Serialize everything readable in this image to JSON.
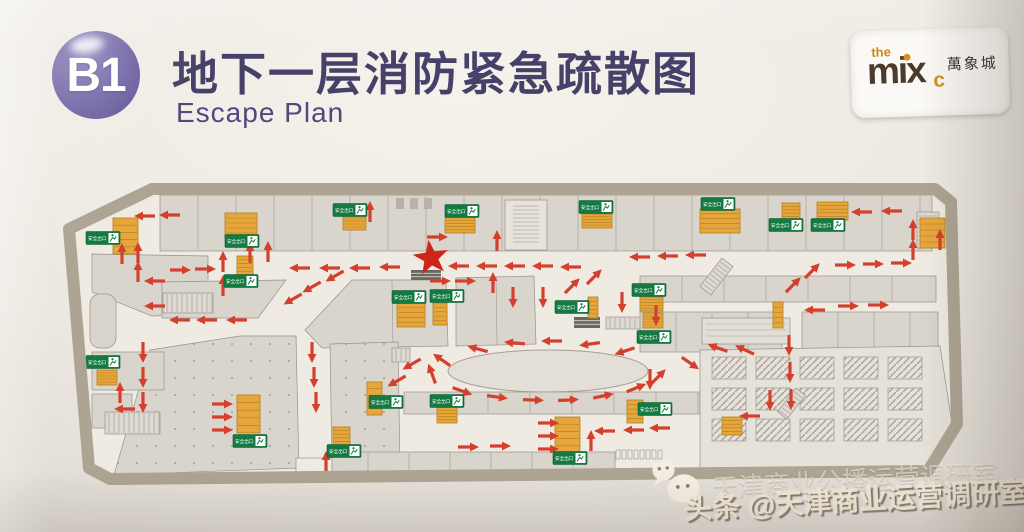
{
  "header": {
    "floor_badge": "B1",
    "title_zh": "地下一层消防紧急疏散图",
    "subtitle_en": "Escape Plan"
  },
  "logo": {
    "the": "the",
    "brand": "mix",
    "sub": "c",
    "cn": "萬象城"
  },
  "watermark": {
    "faint": "天津商业公播运营调研室",
    "main": "头条 @天津商业运营调研室",
    "icon": "wechat-icon"
  },
  "map": {
    "exit_label": "安全出口",
    "colors": {
      "arrow": "#d4402e",
      "exit_green": "#147a42",
      "exit_green_dark": "#0a5b31",
      "stair_orange": "#e7a63c",
      "stair_line": "#b07d1e",
      "star_red": "#cd2519",
      "floor": "#efebe3",
      "block": "#d9d5cc",
      "block_line": "#96918a",
      "border_band": "#aea494",
      "badge_purple": "#6c60a2",
      "title_ink": "#474169"
    },
    "star": {
      "x": 431,
      "y": 258
    },
    "exits": [
      [
        103,
        238
      ],
      [
        242,
        241
      ],
      [
        241,
        281
      ],
      [
        350,
        210
      ],
      [
        462,
        211
      ],
      [
        596,
        207
      ],
      [
        718,
        204
      ],
      [
        786,
        225
      ],
      [
        828,
        225
      ],
      [
        409,
        297
      ],
      [
        447,
        296
      ],
      [
        572,
        307
      ],
      [
        649,
        290
      ],
      [
        654,
        337
      ],
      [
        103,
        362
      ],
      [
        386,
        402
      ],
      [
        447,
        401
      ],
      [
        655,
        409
      ],
      [
        250,
        441
      ],
      [
        344,
        451
      ],
      [
        570,
        458
      ]
    ],
    "stairs": [
      [
        113,
        218,
        25,
        36
      ],
      [
        225,
        213,
        32,
        25
      ],
      [
        237,
        256,
        16,
        19
      ],
      [
        343,
        215,
        23,
        15
      ],
      [
        445,
        217,
        30,
        16
      ],
      [
        582,
        214,
        30,
        14
      ],
      [
        700,
        209,
        40,
        24
      ],
      [
        782,
        203,
        18,
        17
      ],
      [
        817,
        202,
        31,
        18
      ],
      [
        920,
        218,
        25,
        30
      ],
      [
        397,
        303,
        28,
        24
      ],
      [
        433,
        303,
        14,
        22
      ],
      [
        588,
        297,
        10,
        21
      ],
      [
        640,
        297,
        23,
        14
      ],
      [
        643,
        313,
        20,
        15
      ],
      [
        773,
        302,
        10,
        26
      ],
      [
        97,
        370,
        20,
        15
      ],
      [
        237,
        395,
        23,
        38
      ],
      [
        367,
        382,
        15,
        33
      ],
      [
        437,
        407,
        20,
        16
      ],
      [
        555,
        417,
        25,
        36
      ],
      [
        627,
        400,
        16,
        23
      ],
      [
        722,
        417,
        20,
        18
      ],
      [
        333,
        427,
        17,
        18
      ]
    ],
    "arrows": [
      [
        145,
        216,
        180
      ],
      [
        170,
        215,
        180
      ],
      [
        122,
        254,
        -90
      ],
      [
        138,
        253,
        -90
      ],
      [
        138,
        272,
        -90
      ],
      [
        250,
        253,
        -90
      ],
      [
        268,
        252,
        -90
      ],
      [
        223,
        262,
        -90
      ],
      [
        223,
        286,
        -90
      ],
      [
        180,
        270,
        0
      ],
      [
        205,
        269,
        0
      ],
      [
        155,
        281,
        180
      ],
      [
        155,
        306,
        180
      ],
      [
        300,
        268,
        180
      ],
      [
        330,
        268,
        180
      ],
      [
        360,
        268,
        180
      ],
      [
        390,
        267,
        180
      ],
      [
        437,
        237,
        0
      ],
      [
        440,
        281,
        0
      ],
      [
        465,
        281,
        0
      ],
      [
        459,
        266,
        180
      ],
      [
        487,
        266,
        180
      ],
      [
        515,
        266,
        180
      ],
      [
        543,
        266,
        180
      ],
      [
        571,
        267,
        180
      ],
      [
        640,
        257,
        180
      ],
      [
        668,
        256,
        180
      ],
      [
        696,
        255,
        180
      ],
      [
        370,
        212,
        -90
      ],
      [
        497,
        241,
        -90
      ],
      [
        862,
        212,
        180
      ],
      [
        892,
        211,
        180
      ],
      [
        913,
        230,
        -90
      ],
      [
        913,
        250,
        -90
      ],
      [
        845,
        265,
        0
      ],
      [
        873,
        264,
        0
      ],
      [
        901,
        263,
        0
      ],
      [
        793,
        285,
        -45
      ],
      [
        812,
        271,
        -45
      ],
      [
        940,
        240,
        -90
      ],
      [
        180,
        320,
        180
      ],
      [
        207,
        320,
        180
      ],
      [
        237,
        320,
        180
      ],
      [
        335,
        276,
        150
      ],
      [
        312,
        287,
        150
      ],
      [
        293,
        299,
        150
      ],
      [
        143,
        352,
        90
      ],
      [
        143,
        377,
        90
      ],
      [
        143,
        402,
        90
      ],
      [
        125,
        409,
        180
      ],
      [
        120,
        393,
        -90
      ],
      [
        493,
        283,
        -90
      ],
      [
        513,
        297,
        90
      ],
      [
        543,
        297,
        90
      ],
      [
        622,
        302,
        90
      ],
      [
        656,
        315,
        90
      ],
      [
        572,
        286,
        -45
      ],
      [
        594,
        277,
        -45
      ],
      [
        478,
        349,
        195
      ],
      [
        515,
        343,
        185
      ],
      [
        552,
        341,
        180
      ],
      [
        590,
        344,
        172
      ],
      [
        625,
        351,
        162
      ],
      [
        442,
        360,
        215
      ],
      [
        432,
        374,
        250
      ],
      [
        462,
        391,
        20
      ],
      [
        497,
        397,
        8
      ],
      [
        533,
        400,
        2
      ],
      [
        568,
        400,
        -3
      ],
      [
        603,
        396,
        -12
      ],
      [
        636,
        388,
        -22
      ],
      [
        658,
        377,
        -45
      ],
      [
        690,
        363,
        35
      ],
      [
        412,
        364,
        150
      ],
      [
        397,
        381,
        150
      ],
      [
        312,
        352,
        90
      ],
      [
        314,
        377,
        90
      ],
      [
        316,
        402,
        90
      ],
      [
        222,
        404,
        0
      ],
      [
        222,
        417,
        0
      ],
      [
        222,
        430,
        0
      ],
      [
        548,
        423,
        0
      ],
      [
        548,
        436,
        0
      ],
      [
        548,
        449,
        0
      ],
      [
        468,
        447,
        0
      ],
      [
        500,
        446,
        0
      ],
      [
        591,
        441,
        -90
      ],
      [
        605,
        431,
        180
      ],
      [
        634,
        430,
        180
      ],
      [
        660,
        428,
        180
      ],
      [
        770,
        400,
        90
      ],
      [
        750,
        416,
        180
      ],
      [
        745,
        350,
        -155
      ],
      [
        718,
        348,
        -160
      ],
      [
        789,
        345,
        90
      ],
      [
        790,
        372,
        90
      ],
      [
        791,
        399,
        90
      ],
      [
        326,
        462,
        -90
      ],
      [
        650,
        379,
        90
      ],
      [
        815,
        310,
        180
      ],
      [
        848,
        306,
        0
      ],
      [
        878,
        305,
        0
      ]
    ]
  }
}
